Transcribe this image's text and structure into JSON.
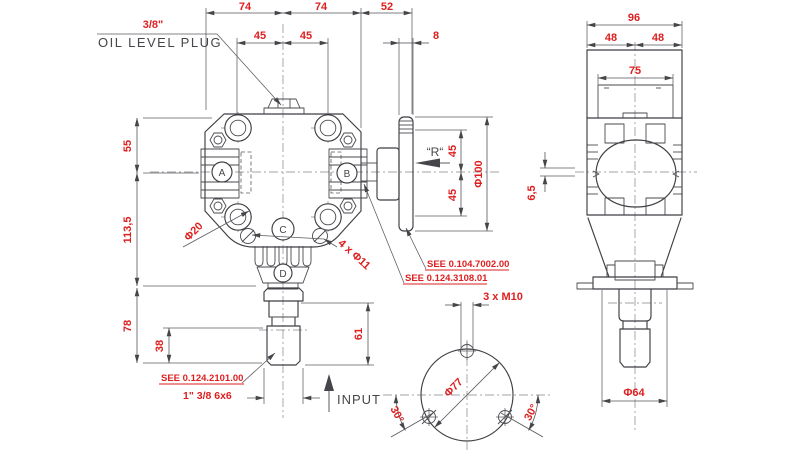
{
  "front": {
    "top": {
      "d74l": "74",
      "d74r": "74",
      "d52": "52",
      "d45l": "45",
      "d45r": "45",
      "d8": "8"
    },
    "left": {
      "d55": "55",
      "d113": "113,5",
      "d78": "78",
      "d38": "38"
    },
    "flange": {
      "d45u": "45",
      "d45d": "45",
      "d100": "Φ100",
      "r_mark": "“R“"
    },
    "marks": {
      "d61": "61",
      "d20": "Φ20",
      "d11": "4 x Φ11",
      "spline": "1\" 3/8 6x6"
    },
    "ports": {
      "a": "A",
      "b": "B",
      "c": "C",
      "d": "D"
    }
  },
  "side": {
    "d96": "96",
    "d48l": "48",
    "d48r": "48",
    "d75": "75",
    "d65": "6,5",
    "d64": "Φ64"
  },
  "bottom": {
    "m10": "3 x M10",
    "d77": "Φ77",
    "a30l": "30°",
    "a30r": "30°"
  },
  "notes": {
    "oil_size": "3/8\"",
    "oil_label": "OIL LEVEL PLUG",
    "input": "INPUT",
    "see_flange": "SEE 0.104.7002.00",
    "see_bearing": "SEE 0.124.3108.01",
    "see_shaft": "SEE 0.124.2101.00"
  },
  "colors": {
    "dim_red": "#de1f1f",
    "line": "#3f3f44"
  }
}
